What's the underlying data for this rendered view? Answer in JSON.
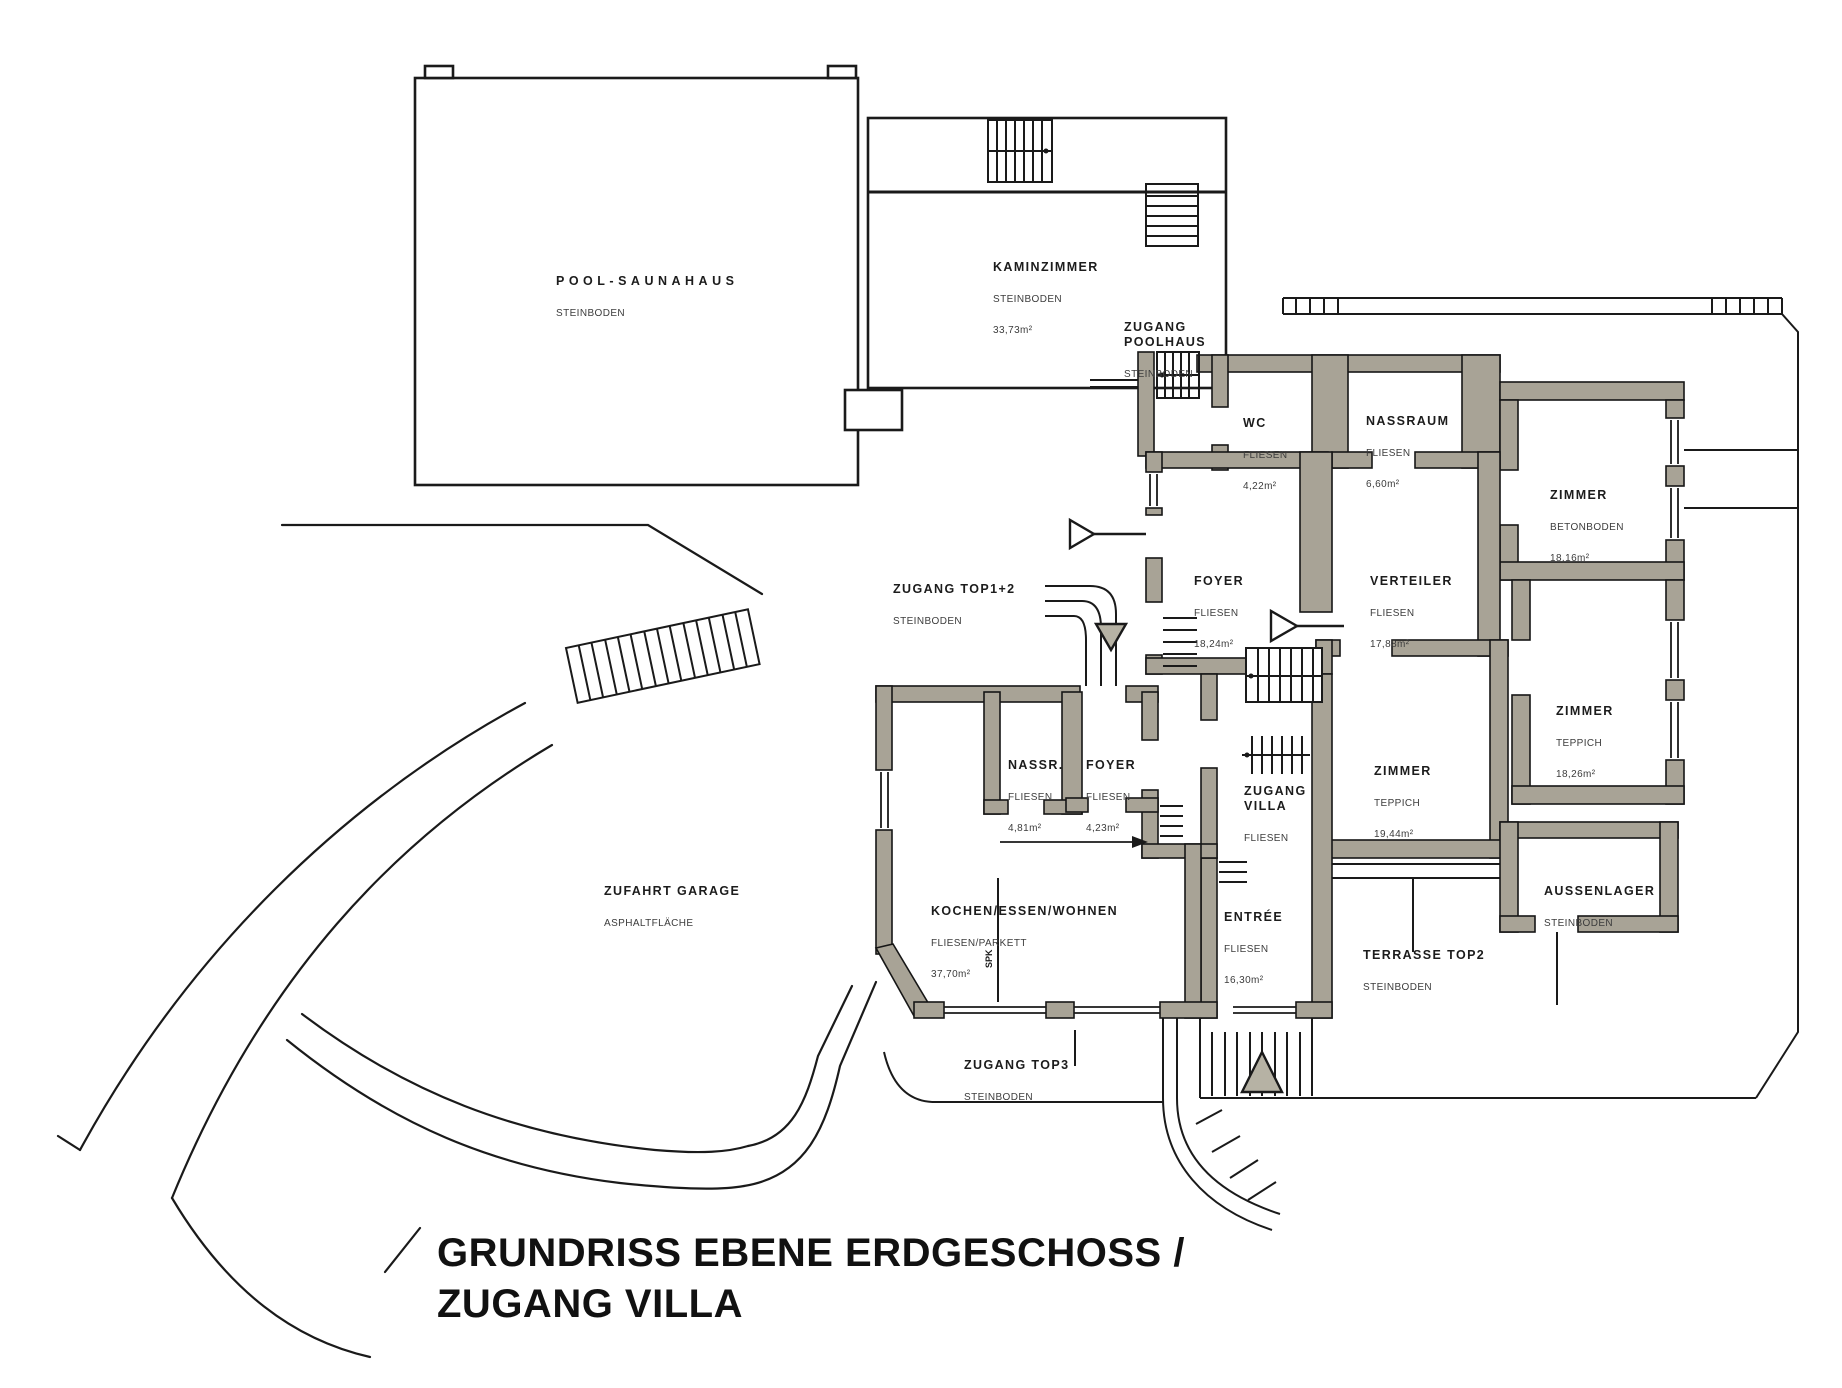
{
  "title": {
    "line1": "GRUNDRISS EBENE ERDGESCHOSS /",
    "line2": "ZUGANG VILLA"
  },
  "colors": {
    "background": "#ffffff",
    "wall_fill": "#a8a396",
    "line": "#1a1a1a",
    "arrow_fill": "#b6b2a4"
  },
  "rooms": [
    {
      "id": "pool_saunahaus",
      "name": "POOL-SAUNAHAUS",
      "floor": "STEINBODEN",
      "area": ""
    },
    {
      "id": "kaminzimmer",
      "name": "KAMINZIMMER",
      "floor": "STEINBODEN",
      "area": "33,73m²"
    },
    {
      "id": "zugang_poolhaus",
      "name": "ZUGANG\nPOOLHAUS",
      "floor": "STEINBODEN",
      "area": ""
    },
    {
      "id": "wc",
      "name": "WC",
      "floor": "FLIESEN",
      "area": "4,22m²"
    },
    {
      "id": "nassraum",
      "name": "NASSRAUM",
      "floor": "FLIESEN",
      "area": "6,60m²"
    },
    {
      "id": "zimmer_nordost",
      "name": "ZIMMER",
      "floor": "BETONBODEN",
      "area": "18,16m²"
    },
    {
      "id": "foyer",
      "name": "FOYER",
      "floor": "FLIESEN",
      "area": "18,24m²"
    },
    {
      "id": "verteiler",
      "name": "VERTEILER",
      "floor": "FLIESEN",
      "area": "17,88m²"
    },
    {
      "id": "zimmer_ost",
      "name": "ZIMMER",
      "floor": "TEPPICH",
      "area": "18,26m²"
    },
    {
      "id": "zugang_top12",
      "name": "ZUGANG TOP1+2",
      "floor": "STEINBODEN",
      "area": ""
    },
    {
      "id": "nassr",
      "name": "NASSR.",
      "floor": "FLIESEN",
      "area": "4,81m²"
    },
    {
      "id": "foyer_klein",
      "name": "FOYER",
      "floor": "FLIESEN",
      "area": "4,23m²"
    },
    {
      "id": "zugang_villa",
      "name": "ZUGANG\nVILLA",
      "floor": "FLIESEN",
      "area": ""
    },
    {
      "id": "zimmer_mitte",
      "name": "ZIMMER",
      "floor": "TEPPICH",
      "area": "19,44m²"
    },
    {
      "id": "zufahrt_garage",
      "name": "ZUFAHRT GARAGE",
      "floor": "ASPHALTFLÄCHE",
      "area": ""
    },
    {
      "id": "kochen_essen_wohnen",
      "name": "KOCHEN/ESSEN/WOHNEN",
      "floor": "FLIESEN/PARKETT",
      "area": "37,70m²"
    },
    {
      "id": "entree",
      "name": "ENTRÉE",
      "floor": "FLIESEN",
      "area": "16,30m²"
    },
    {
      "id": "aussenlager",
      "name": "AUSSENLAGER",
      "floor": "STEINBODEN",
      "area": ""
    },
    {
      "id": "terrasse_top2",
      "name": "TERRASSE TOP2",
      "floor": "STEINBODEN",
      "area": ""
    },
    {
      "id": "zugang_top3",
      "name": "ZUGANG TOP3",
      "floor": "STEINBODEN",
      "area": ""
    }
  ],
  "misc": {
    "kitchen_note": "SPK"
  }
}
